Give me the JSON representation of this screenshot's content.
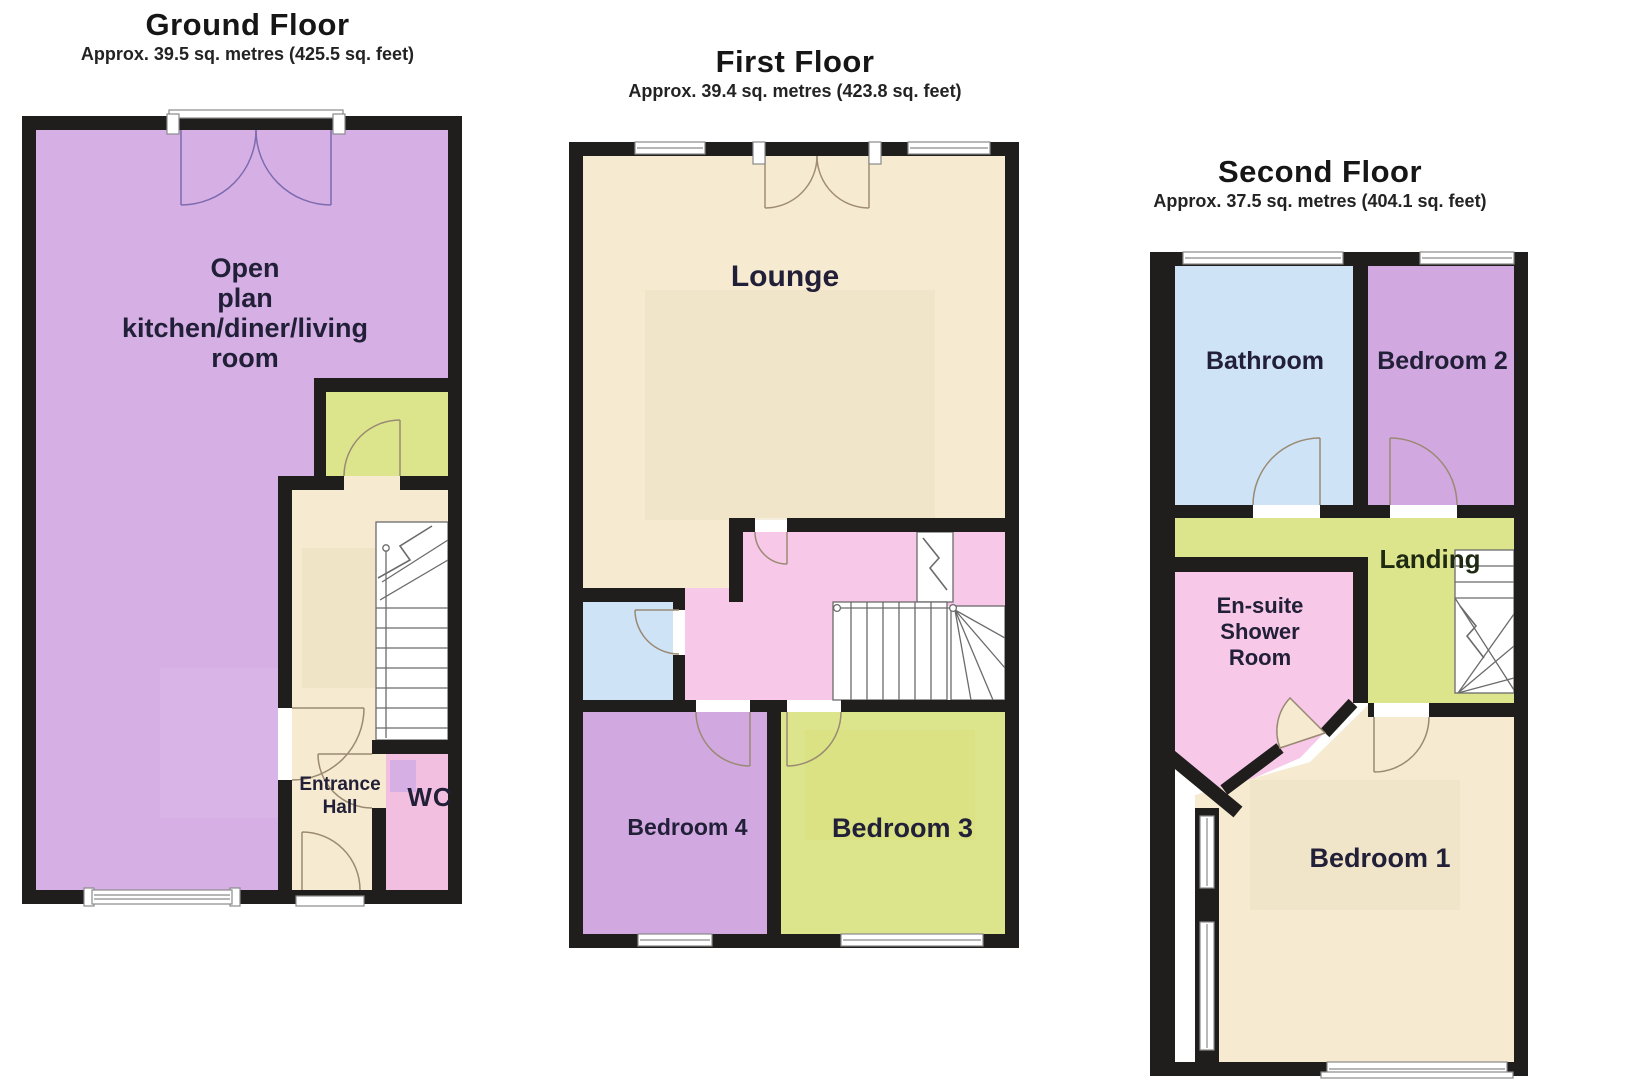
{
  "document": {
    "type": "property-floorplan",
    "background": "#ffffff"
  },
  "colors": {
    "wall": "#201e1c",
    "open_plan_purple": "#d6b0e4",
    "bedroom_purple": "#d2a8e0",
    "cream": "#f6ead0",
    "cream_shade": "#ece0c2",
    "green": "#dde58c",
    "pink": "#f8c8e8",
    "wc_pink": "#f3bfe0",
    "blue": "#cfe3f6",
    "stair_white": "#ffffff",
    "door_line": "#9a8a74",
    "french_door_line": "#7d6bb0"
  },
  "floors": [
    {
      "id": "ground",
      "title": "Ground Floor",
      "subtitle": "Approx. 39.5 sq. metres (425.5 sq. feet)",
      "rooms": {
        "open_plan": [
          "Open",
          "plan",
          "kitchen/diner/living",
          "room"
        ],
        "entrance_hall": [
          "Entrance",
          "Hall"
        ],
        "wc": "WC"
      }
    },
    {
      "id": "first",
      "title": "First Floor",
      "subtitle": "Approx. 39.4 sq. metres (423.8 sq. feet)",
      "rooms": {
        "lounge": "Lounge",
        "bedroom4": "Bedroom 4",
        "bedroom3": "Bedroom 3"
      }
    },
    {
      "id": "second",
      "title": "Second Floor",
      "subtitle": "Approx. 37.5 sq. metres (404.1 sq. feet)",
      "rooms": {
        "bathroom": "Bathroom",
        "bedroom2": "Bedroom 2",
        "landing": "Landing",
        "ensuite": [
          "En-suite",
          "Shower",
          "Room"
        ],
        "bedroom1": "Bedroom 1"
      }
    }
  ]
}
